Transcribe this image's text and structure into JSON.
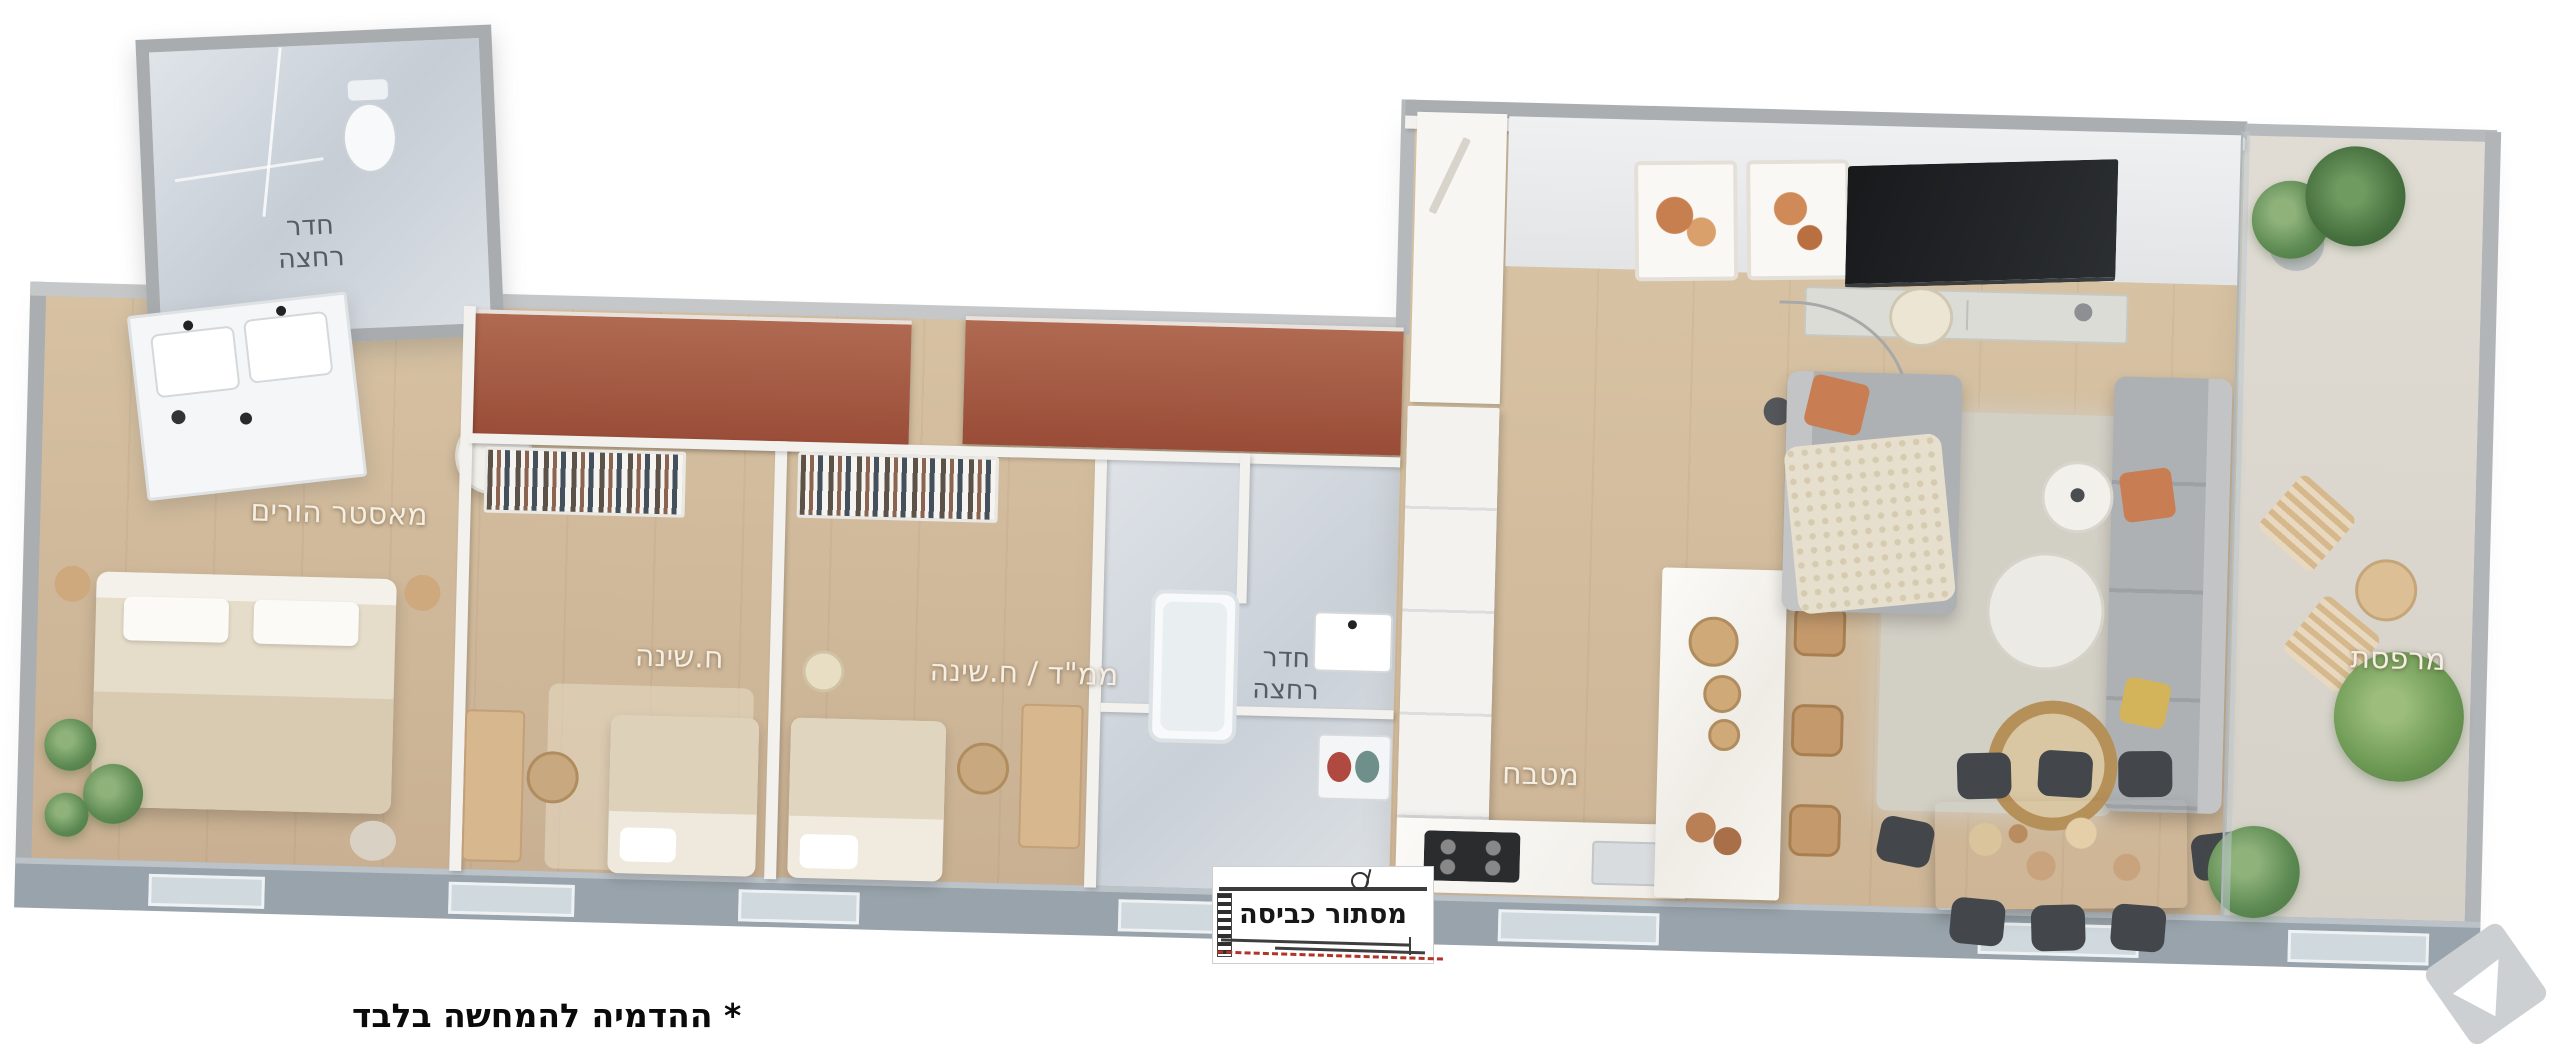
{
  "rooms": {
    "master_bathroom": {
      "label_line1": "חדר",
      "label_line2": "רחצה"
    },
    "master_bedroom": {
      "label": "מאסטר הורים"
    },
    "bedroom": {
      "label": "ח.שינה"
    },
    "safe_room_bedroom": {
      "label": "ממ\"ד / ח.שינה"
    },
    "bathroom": {
      "label_line1": "חדר",
      "label_line2": "רחצה"
    },
    "kitchen": {
      "label": "מטבח"
    },
    "balcony": {
      "label": "מרפסת"
    }
  },
  "overlay": {
    "laundry_box_label": "מסתור כביסה"
  },
  "footnote": {
    "text": "* ההדמיה להמחשה בלבד"
  },
  "colors": {
    "wall_gray": "#a9adb0",
    "window_wall": "#98a3ab",
    "terracotta_accent": "#a3553f",
    "wood_floor": "#cdb394",
    "marble_floor": "#ccd2d8",
    "balcony_floor": "#dbd7cf",
    "sofa_gray": "#aeb1b3",
    "pillow_orange": "#c97d52",
    "pillow_yellow": "#d4b45a",
    "laundry_line_red": "#b23327",
    "label_light": "#f5eee2",
    "label_dark": "#565b64",
    "text_black": "#0a0a0a"
  }
}
